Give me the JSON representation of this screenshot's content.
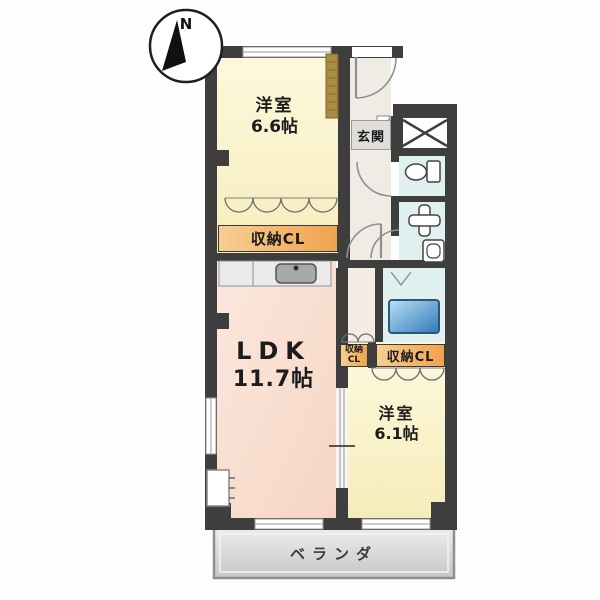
{
  "compass": {
    "label": "N"
  },
  "rooms": {
    "bedroom_top": {
      "name": "洋室",
      "size": "6.6帖"
    },
    "entrance": {
      "label": "玄関"
    },
    "ldk": {
      "name": "LDK",
      "size": "11.7帖"
    },
    "bedroom_bottom": {
      "name": "洋室",
      "size": "6.1帖"
    },
    "veranda": {
      "label": "ベランダ"
    }
  },
  "closets": {
    "bedroom_top_closet": {
      "label": "収納CL"
    },
    "hall_closet": {
      "line1": "収納",
      "line2": "CL"
    },
    "bedroom_bottom_closet": {
      "label": "収納CL"
    }
  },
  "icons": {
    "north_arrow": "north-arrow",
    "toilet": "toilet-top-view",
    "washbasin": "washbasin-cross",
    "washing_machine": "washing-machine",
    "bathtub": "bathtub",
    "kitchen_sink": "kitchen-sink",
    "pipe_shaft": "shaft-x-box",
    "door_arc": "door-swing-arc",
    "bifold_door": "bifold-closet-door",
    "sliding_panel": "wood-sliding-door"
  },
  "colors": {
    "wall": "#3E3E3E",
    "bedroom_fill": "#FBF5D2",
    "ldk_fill": "#F9E0D2",
    "wet_area_fill": "#DFF0EE",
    "closet_bar": "#F0A953",
    "bathtub": "#2F79BC",
    "veranda_fill": "#D9D9D9",
    "sliding_panel": "#AA8C42"
  }
}
